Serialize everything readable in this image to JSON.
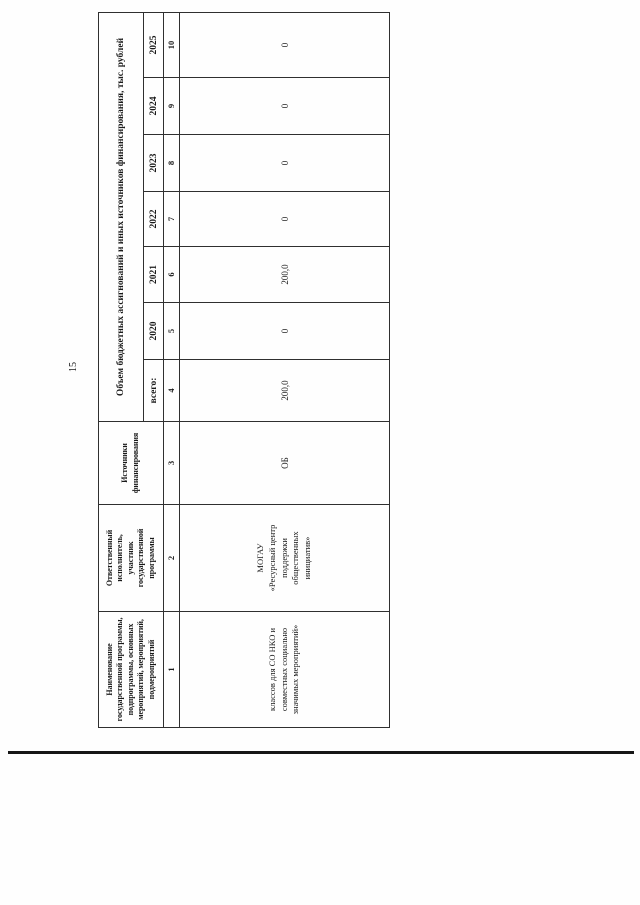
{
  "page": {
    "number": "15"
  },
  "table": {
    "header": {
      "col_name": "Наименование\nгосударственной программы,\nподпрограммы, основных\nмероприятий, мероприятий,\nподмероприятий",
      "col_executor": "Ответственный\nисполнитель,\nучастник\nгосударственной\nпрограммы",
      "col_sources": "Источники\nфинансирования",
      "span_financing": "Объем бюджетных ассигнований и иных источников финансирования, тыс. рублей",
      "sub_cols": [
        "всего:",
        "2020",
        "2021",
        "2022",
        "2023",
        "2024",
        "2025"
      ],
      "col_numbers": [
        "1",
        "2",
        "3",
        "4",
        "5",
        "6",
        "7",
        "8",
        "9",
        "10"
      ]
    },
    "rows": [
      {
        "program_name": "классов для СО НКО и\nсовместных социально\nзначимых мероприятий»",
        "executor": "МОГАУ\n«Ресурсный центр\nподдержки\nобщественных\nинициатив»",
        "source": "ОБ",
        "total": "200,0",
        "y2020": "0",
        "y2021": "200,0",
        "y2022": "0",
        "y2023": "0",
        "y2024": "0",
        "y2025": "0"
      }
    ]
  }
}
